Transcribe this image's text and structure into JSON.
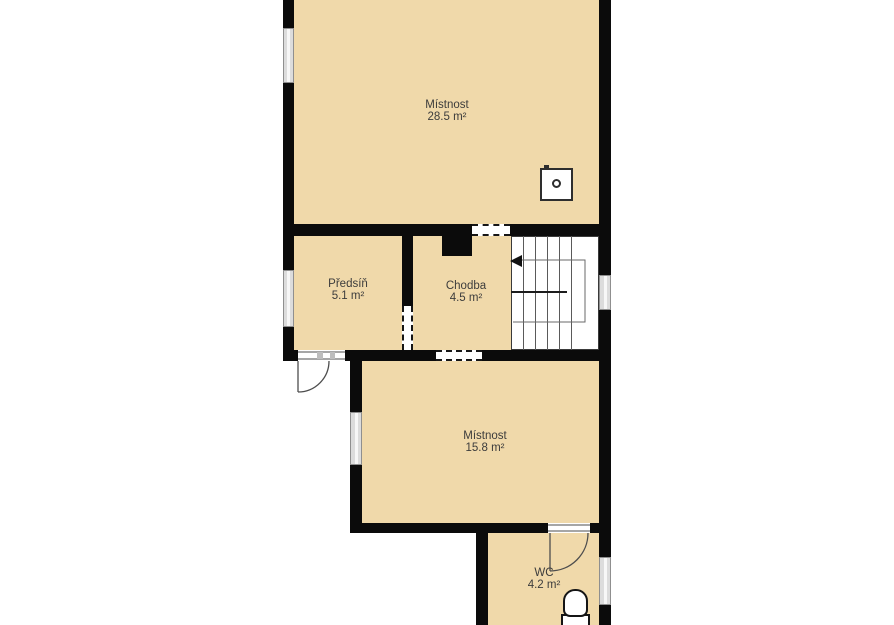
{
  "plan": {
    "type": "floor-plan",
    "rooms": [
      {
        "name": "Místnost",
        "area": "28.5 m²"
      },
      {
        "name": "Předsíň",
        "area": "5.1 m²"
      },
      {
        "name": "Chodba",
        "area": "4.5 m²"
      },
      {
        "name": "Místnost",
        "area": "15.8 m²"
      },
      {
        "name": "WC",
        "area": "4.2 m²"
      }
    ],
    "fixtures": [
      "stove-icon",
      "toilet-icon",
      "staircase",
      "stair-direction-arrow-left"
    ],
    "openings": {
      "windows": 5,
      "doors": 2,
      "open-passages": 3
    },
    "colors": {
      "floor": "#F0D9AA",
      "wall": "#0B0B0B",
      "window": "#DCDCDC",
      "stairs": "#FFFFFF",
      "text": "#3C3C3C",
      "background": "#FFFFFF"
    }
  }
}
